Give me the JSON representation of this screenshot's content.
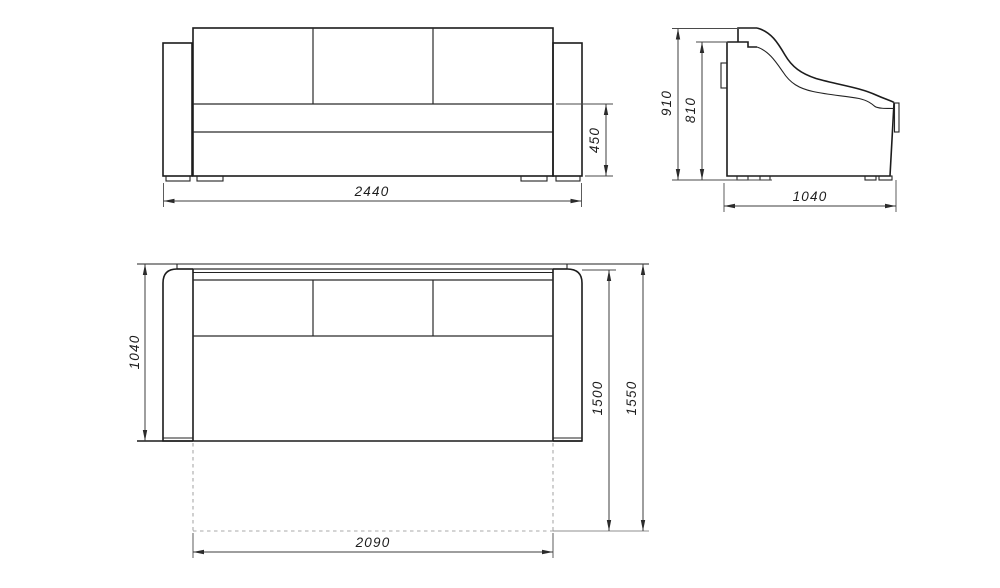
{
  "title": "sofa-technical-drawing",
  "units": "mm",
  "colors": {
    "outline": "#1c1c1c",
    "dimension": "#3c3c3c",
    "hidden_line": "#a8a8a8",
    "background": "#ffffff"
  },
  "views": {
    "front": {
      "label": "front-view",
      "dimensions": {
        "overall_width": "2440",
        "seat_height": "450"
      }
    },
    "side": {
      "label": "side-view",
      "dimensions": {
        "overall_height": "910",
        "back_height": "810",
        "overall_depth": "1040"
      }
    },
    "plan": {
      "label": "plan-view",
      "dimensions": {
        "sofa_depth": "1040",
        "bed_extension": "1500",
        "bed_extension_total": "1550",
        "sleeping_width": "2090"
      }
    }
  }
}
